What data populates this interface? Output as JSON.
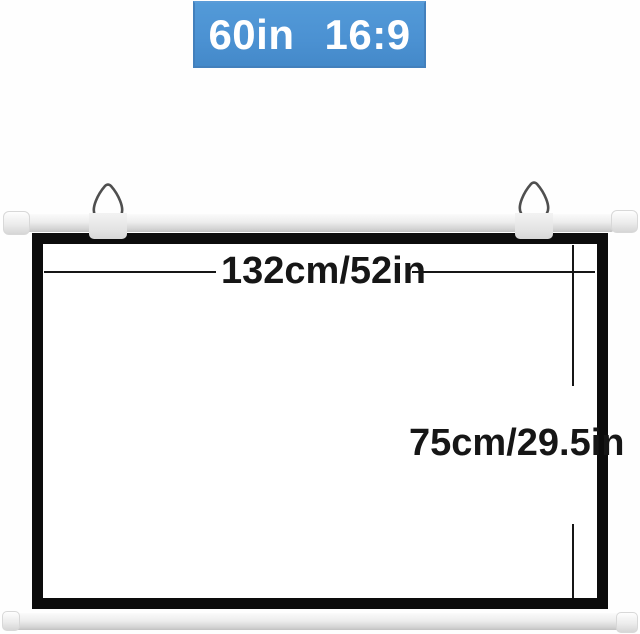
{
  "badge": {
    "size": "60in",
    "aspect_ratio": "16:9"
  },
  "dimensions": {
    "width": "132cm/52in",
    "height": "75cm/29.5in"
  },
  "colors": {
    "badge_bg": "#4b91d2",
    "badge_border": "#4380bc",
    "badge_text": "#ffffff",
    "frame_border": "#0c0c0c",
    "screen_surface": "#ffffff",
    "dimension_ink": "#161616",
    "bar_metal": "#e8e8e8"
  }
}
